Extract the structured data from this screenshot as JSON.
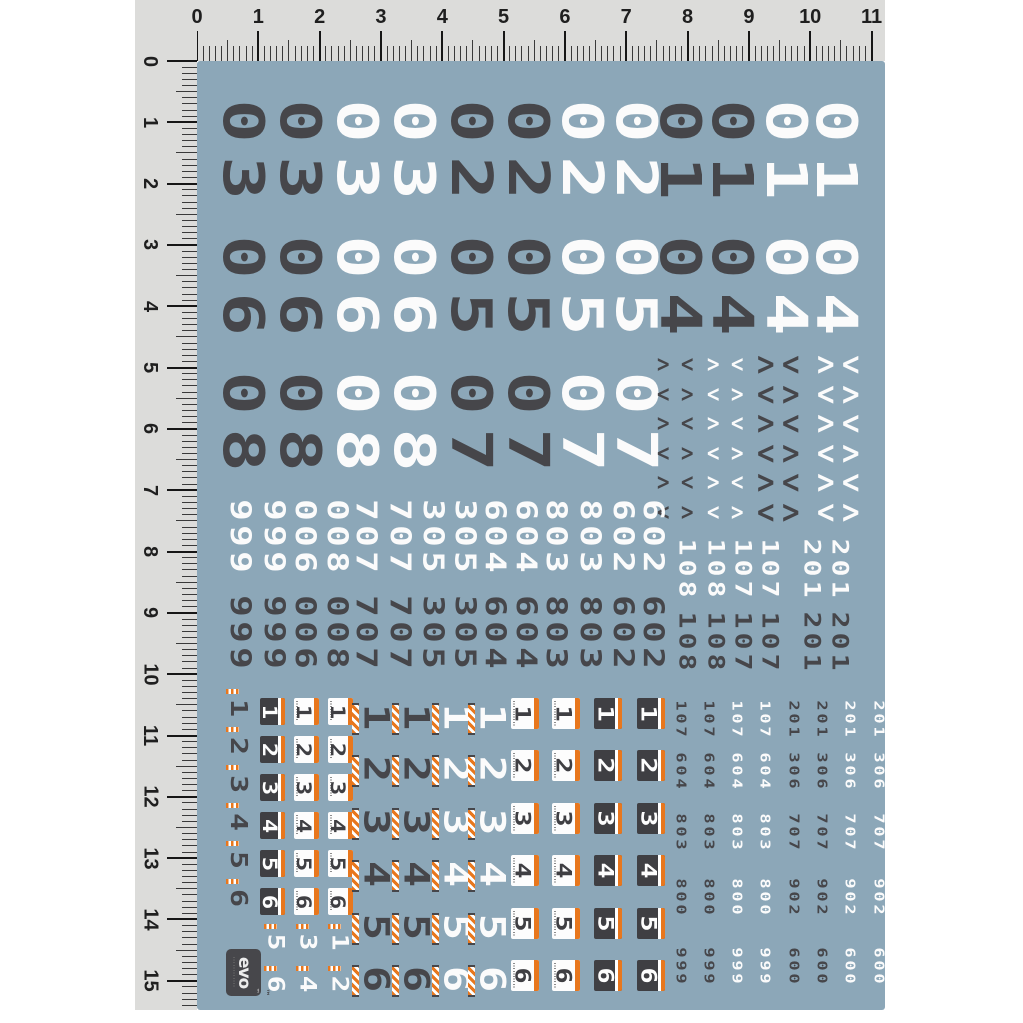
{
  "app": {
    "title": "EVO racing number decal sheet over metric rulers"
  },
  "colors": {
    "page_bg": "#ffffff",
    "ruler_bg": "#dcdcda",
    "ruler_ink": "#1f1f1f",
    "tick": "#3a3a3a",
    "sheet_bg": "#8ca7b8",
    "dark": "#46464a",
    "white": "#fbfbfb",
    "orange": "#e8771d",
    "box_dark": "#3f3f43",
    "logo_bg": "#47474b"
  },
  "ruler": {
    "top_labels": [
      "0",
      "1",
      "2",
      "3",
      "4",
      "5",
      "6",
      "7",
      "8",
      "9",
      "10",
      "11"
    ],
    "left_labels": [
      "0",
      "1",
      "2",
      "3",
      "4",
      "5",
      "6",
      "7",
      "8",
      "9",
      "10",
      "11",
      "12",
      "13",
      "14",
      "15"
    ],
    "px_per_unit": 61.32,
    "minor_per_unit": 10
  },
  "big_columns": [
    {
      "x": 222,
      "color": "dark",
      "text": "03 06 08"
    },
    {
      "x": 279,
      "color": "dark",
      "text": "03 06 08"
    },
    {
      "x": 336,
      "color": "white",
      "text": "03 06 08"
    },
    {
      "x": 393,
      "color": "white",
      "text": "03 06 08"
    },
    {
      "x": 450,
      "color": "dark",
      "text": "02 05 07"
    },
    {
      "x": 507,
      "color": "dark",
      "text": "02 05 07"
    },
    {
      "x": 561,
      "color": "white",
      "text": "02 05 07"
    },
    {
      "x": 615,
      "color": "white",
      "text": "02 05 07"
    },
    {
      "x": 659,
      "color": "dark",
      "text": "01 04"
    },
    {
      "x": 711,
      "color": "dark",
      "text": "01 04"
    },
    {
      "x": 765,
      "color": "white",
      "text": "01 04"
    },
    {
      "x": 815,
      "color": "white",
      "text": "01 04"
    }
  ],
  "chevrons": {
    "glyph_right": ">",
    "glyph_left": "<",
    "rows": 6,
    "row_pitch": 29.5,
    "start_y": 350,
    "columns": [
      {
        "x": 655,
        "color": "dark",
        "size": "small",
        "phase": 0
      },
      {
        "x": 679,
        "color": "dark",
        "size": "small",
        "phase": 1
      },
      {
        "x": 705,
        "color": "white",
        "size": "small",
        "phase": 0
      },
      {
        "x": 729,
        "color": "white",
        "size": "small",
        "phase": 1
      },
      {
        "x": 755,
        "color": "dark",
        "size": "large",
        "phase": 0
      },
      {
        "x": 780,
        "color": "dark",
        "size": "large",
        "phase": 1
      },
      {
        "x": 815,
        "color": "white",
        "size": "large",
        "phase": 0
      },
      {
        "x": 840,
        "color": "white",
        "size": "large",
        "phase": 1
      }
    ]
  },
  "medium_wide": {
    "numbers": [
      "999",
      "999",
      "006",
      "008",
      "707",
      "707",
      "305",
      "305",
      "604",
      "604",
      "803",
      "803",
      "602",
      "602"
    ],
    "xs": [
      227,
      261,
      292,
      324,
      353,
      387,
      420,
      452,
      482,
      513,
      543,
      577,
      610,
      640
    ],
    "rows": [
      {
        "y": 497,
        "color": "white"
      },
      {
        "y": 593,
        "color": "dark"
      }
    ]
  },
  "medium_narrow": {
    "numbers": [
      "108",
      "108",
      "107",
      "107",
      "201",
      "201"
    ],
    "xs": [
      676,
      705,
      732,
      759,
      801,
      829
    ],
    "rows": [
      {
        "y": 536,
        "color": "white"
      },
      {
        "y": 609,
        "color": "dark"
      }
    ]
  },
  "bottom": {
    "digit_column": {
      "x": 228,
      "start_y": 696,
      "pitch": 38,
      "digits": [
        "1",
        "2",
        "3",
        "4",
        "5",
        "6"
      ],
      "color": "dark"
    },
    "small_boxes": {
      "start_y": 698,
      "pitch": 38,
      "digits": [
        "1",
        "2",
        "3",
        "4",
        "5",
        "6"
      ],
      "columns": [
        {
          "x": 260,
          "style": "dark"
        },
        {
          "x": 294,
          "style": "light"
        },
        {
          "x": 328,
          "style": "light"
        }
      ]
    },
    "large_digit_columns": {
      "start_y": 702,
      "pitch": 52.4,
      "digits": [
        "1",
        "2",
        "3",
        "4",
        "5",
        "6"
      ],
      "columns": [
        {
          "x": 362,
          "color": "dark"
        },
        {
          "x": 402,
          "color": "dark"
        },
        {
          "x": 442,
          "color": "white"
        },
        {
          "x": 478,
          "color": "white"
        }
      ]
    },
    "large_boxes": {
      "start_y": 698,
      "pitch": 52.4,
      "digits": [
        "1",
        "2",
        "3",
        "4",
        "5",
        "6"
      ],
      "columns": [
        {
          "x": 511,
          "style": "light"
        },
        {
          "x": 552,
          "style": "light"
        },
        {
          "x": 594,
          "style": "dark"
        },
        {
          "x": 637,
          "style": "dark"
        }
      ]
    },
    "number_sets": {
      "A": [
        "107",
        "604",
        "803",
        "800",
        "999"
      ],
      "B": [
        "201",
        "306",
        "707",
        "902",
        "600"
      ]
    },
    "number_rows_y": [
      699,
      751,
      812,
      877,
      946
    ],
    "number_columns": [
      {
        "x": 673,
        "color": "dark",
        "set": "A"
      },
      {
        "x": 701,
        "color": "dark",
        "set": "A"
      },
      {
        "x": 729,
        "color": "white",
        "set": "A"
      },
      {
        "x": 757,
        "color": "white",
        "set": "A"
      },
      {
        "x": 786,
        "color": "dark",
        "set": "B"
      },
      {
        "x": 814,
        "color": "dark",
        "set": "B"
      },
      {
        "x": 842,
        "color": "white",
        "set": "B"
      },
      {
        "x": 871,
        "color": "white",
        "set": "B"
      }
    ],
    "extra_pairs": {
      "ys": [
        931,
        973
      ],
      "color": "white",
      "columns": [
        {
          "x": 266,
          "digits": [
            "5",
            "6"
          ]
        },
        {
          "x": 298,
          "digits": [
            "3",
            "4"
          ]
        },
        {
          "x": 330,
          "digits": [
            "1",
            "2"
          ]
        }
      ]
    }
  },
  "logo": {
    "text": "evo",
    "tm": "™"
  }
}
